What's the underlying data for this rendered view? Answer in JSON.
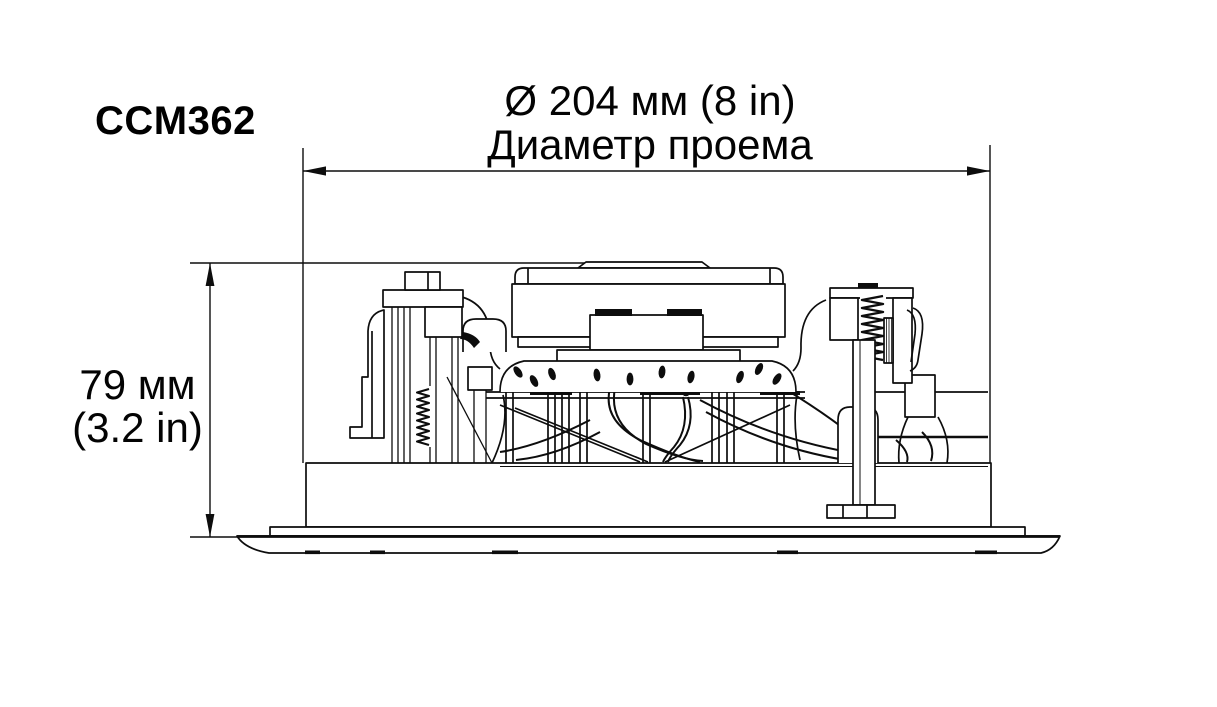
{
  "labels": {
    "title": "CCM362",
    "diameter_value": "Ø 204 мм (8 in)",
    "diameter_caption": "Диаметр проема",
    "depth_value": "79 мм",
    "depth_imperial": "(3.2 in)"
  },
  "drawing": {
    "description": "side cross-section technical drawing of in-ceiling speaker",
    "dimensions": [
      {
        "name": "cutout-diameter",
        "value_mm": 204,
        "value_in": 8,
        "caption_ru": "Диаметр проема"
      },
      {
        "name": "mounting-depth",
        "value_mm": 79,
        "value_in": 3.2
      }
    ]
  },
  "colors": {
    "line": "#0d0d0d",
    "background": "#ffffff",
    "text": "#030303"
  }
}
